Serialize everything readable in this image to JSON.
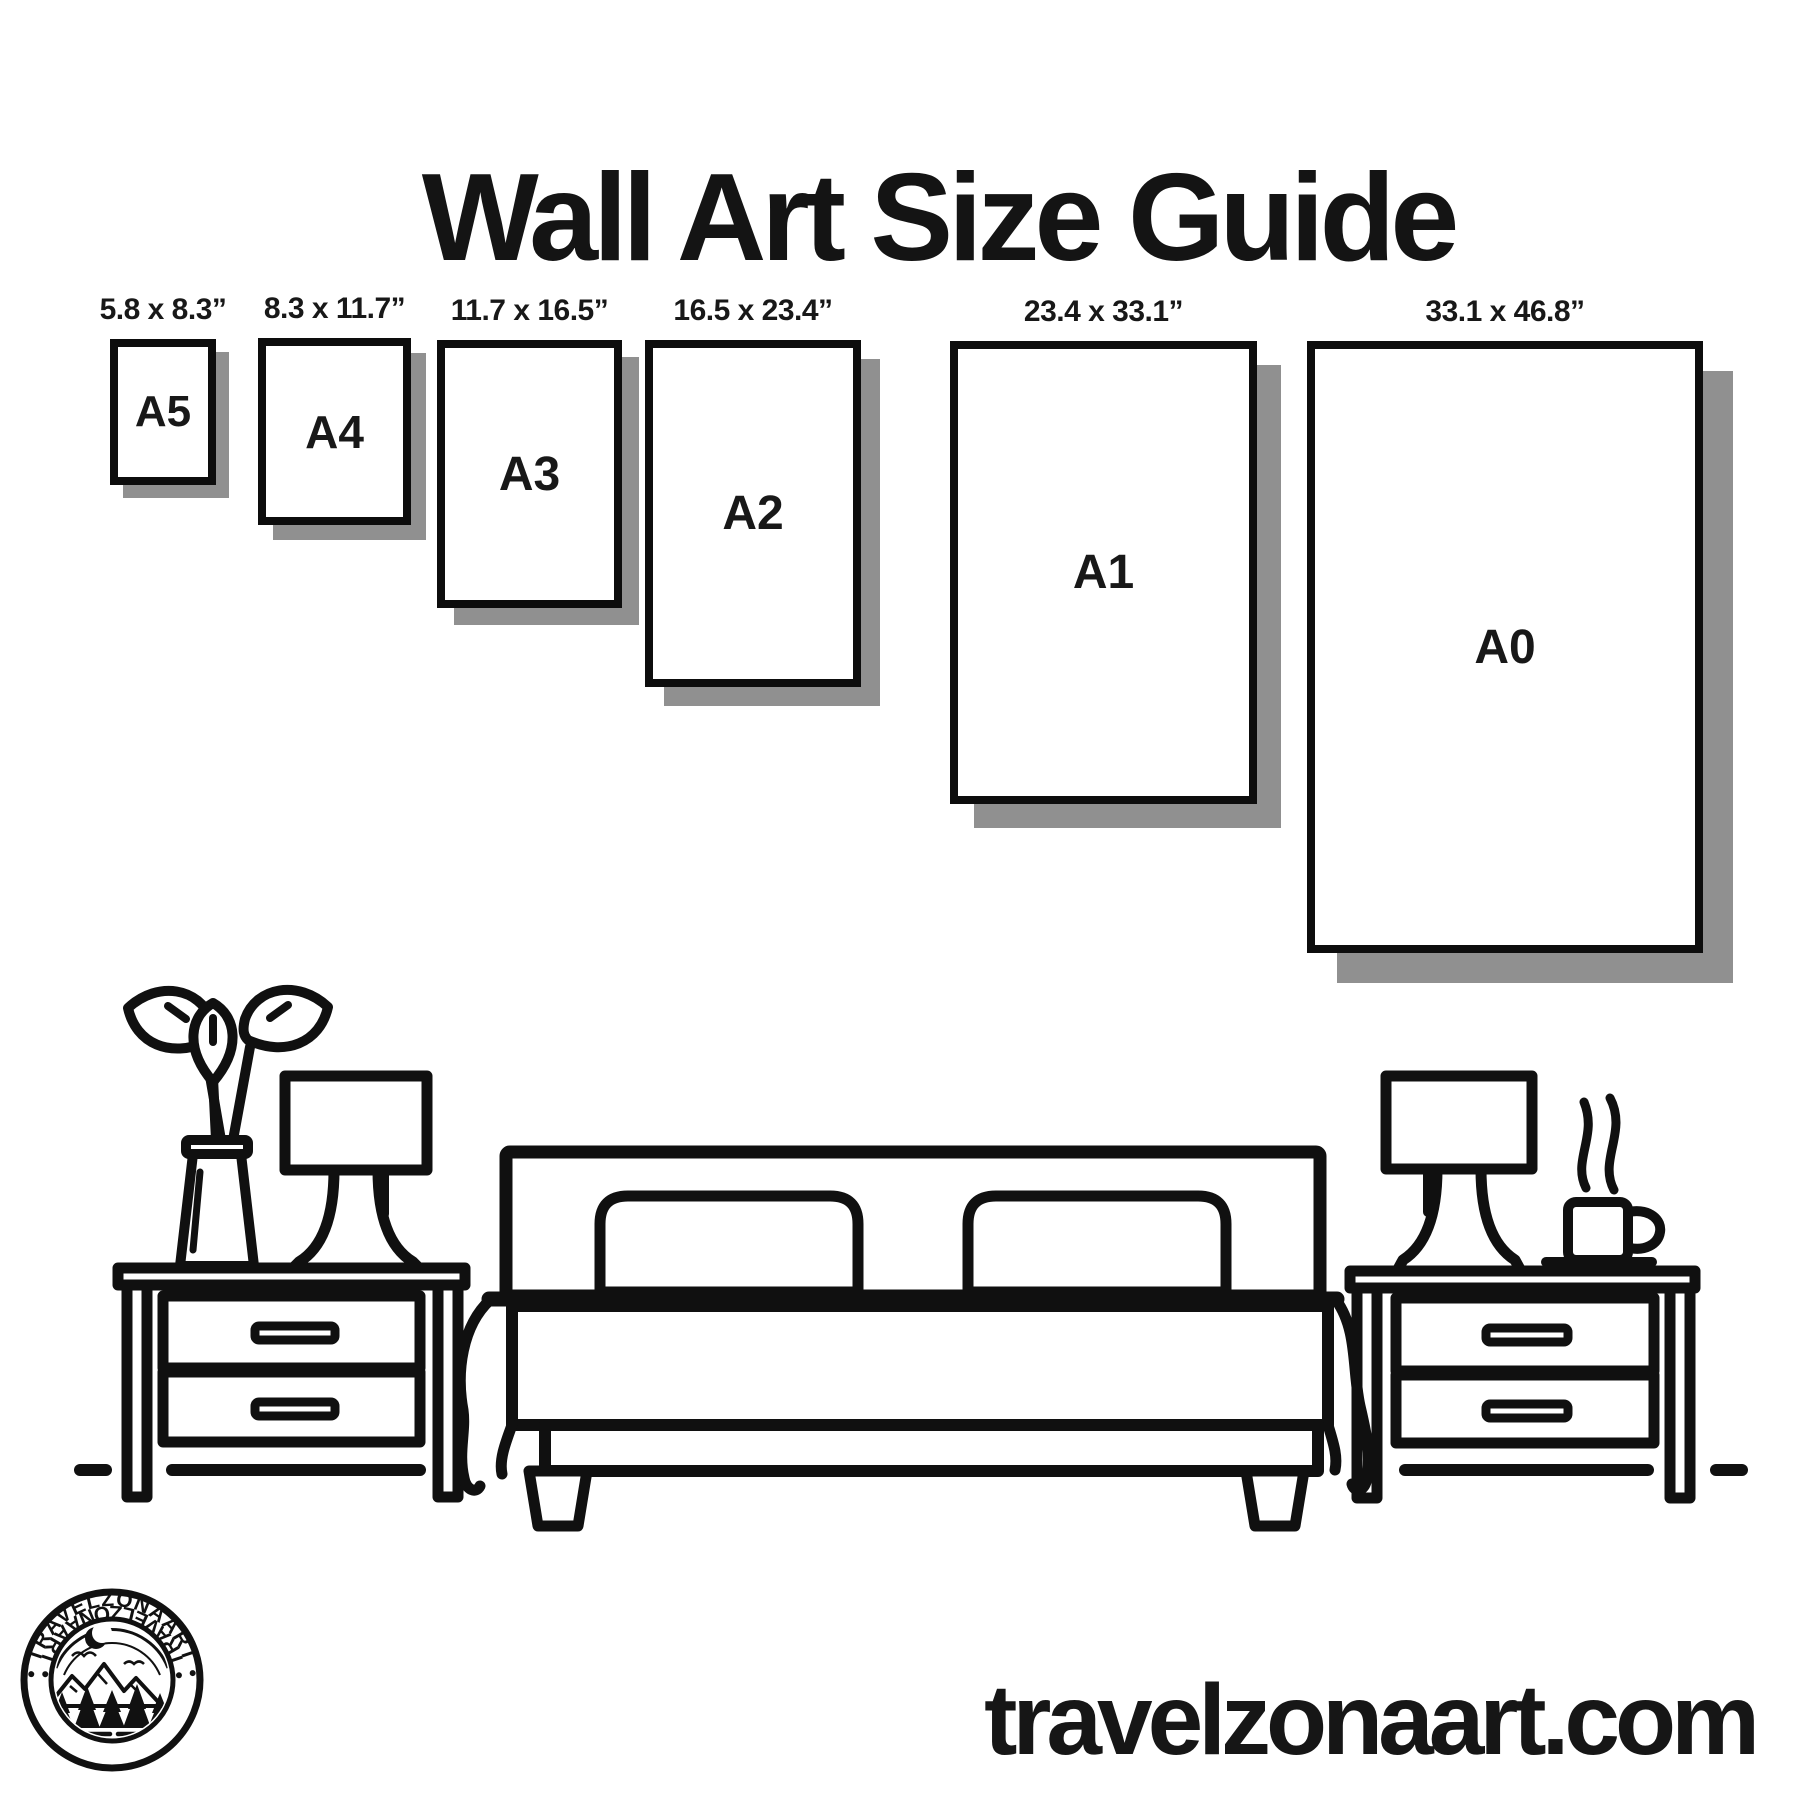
{
  "title": "Wall Art Size Guide",
  "frames": [
    {
      "name": "A5",
      "dims": "5.8 x 8.3”"
    },
    {
      "name": "A4",
      "dims": "8.3 x 11.7”"
    },
    {
      "name": "A3",
      "dims": "11.7 x 16.5”"
    },
    {
      "name": "A2",
      "dims": "16.5 x 23.4”"
    },
    {
      "name": "A1",
      "dims": "23.4 x 33.1”"
    },
    {
      "name": "A0",
      "dims": "33.1 x 46.8”"
    }
  ],
  "website": "travelzonaart.com",
  "logo": {
    "brand": "TRAVELZONAART",
    "ring_top": "• TRAVELZONAART •",
    "ring_bottom": "• TRAVELZONAART •"
  },
  "colors": {
    "background": "#ffffff",
    "ink": "#101010",
    "frame_border": "#0d0d0d",
    "shadow": "#909090"
  },
  "scene": {
    "items": [
      "vase-with-plant",
      "table-lamp-left",
      "nightstand-left",
      "double-bed",
      "pillow-left",
      "pillow-right",
      "blanket",
      "nightstand-right",
      "table-lamp-right",
      "steaming-coffee-mug",
      "floor-line"
    ]
  }
}
